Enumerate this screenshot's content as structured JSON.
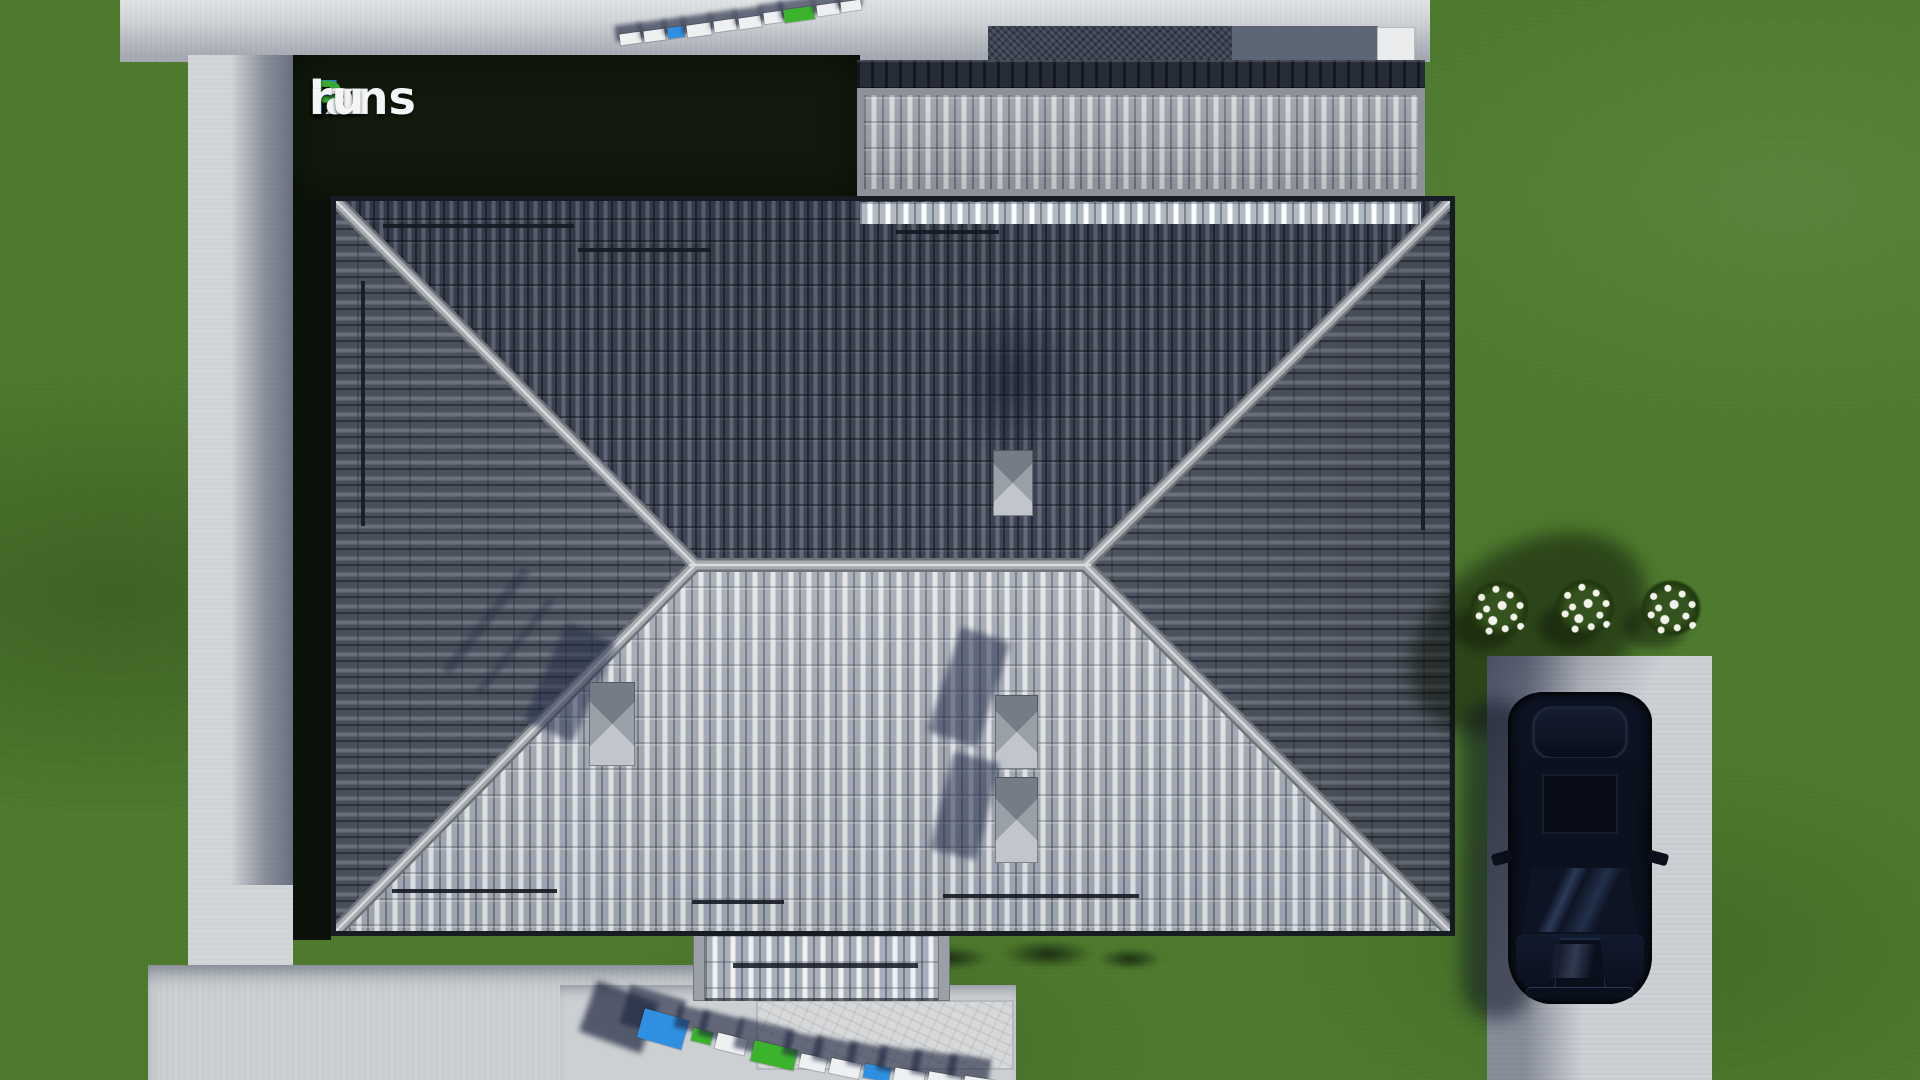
{
  "watermark": {
    "text": "FixPlans.ru",
    "background": "#111a0c",
    "segments": [
      {
        "t": "F",
        "c": "#2f7ee2"
      },
      {
        "t": "ix",
        "c": "#f4f5f6"
      },
      {
        "t": "P",
        "c": "#39a935"
      },
      {
        "t": "lans",
        "c": "#f4f5f6"
      },
      {
        "t": ".",
        "c": "#2f7ee2"
      },
      {
        "t": "ru",
        "c": "#f4f5f6"
      }
    ]
  },
  "ground_logos": {
    "colors": {
      "blue": "#2f8fe0",
      "green": "#3cb32d",
      "white": "#eef0f2"
    },
    "top": {
      "blocks": [
        {
          "x": 620,
          "y": 33,
          "w": 21,
          "h": 11,
          "rot": -8,
          "c": "white"
        },
        {
          "x": 644,
          "y": 30,
          "w": 21,
          "h": 11,
          "rot": -8,
          "c": "white"
        },
        {
          "x": 668,
          "y": 27,
          "w": 16,
          "h": 11,
          "rot": -8,
          "c": "blue"
        },
        {
          "x": 687,
          "y": 24,
          "w": 24,
          "h": 12,
          "rot": -8,
          "c": "white"
        },
        {
          "x": 714,
          "y": 20,
          "w": 22,
          "h": 11,
          "rot": -8,
          "c": "white"
        },
        {
          "x": 739,
          "y": 17,
          "w": 22,
          "h": 11,
          "rot": -8,
          "c": "white"
        },
        {
          "x": 764,
          "y": 12,
          "w": 18,
          "h": 11,
          "rot": -8,
          "c": "white"
        },
        {
          "x": 784,
          "y": 8,
          "w": 30,
          "h": 13,
          "rot": -8,
          "c": "green"
        },
        {
          "x": 817,
          "y": 4,
          "w": 22,
          "h": 11,
          "rot": -8,
          "c": "white"
        },
        {
          "x": 841,
          "y": 1,
          "w": 20,
          "h": 10,
          "rot": -8,
          "c": "white"
        }
      ]
    },
    "bottom": {
      "blocks": [
        {
          "x": 640,
          "y": 1014,
          "w": 46,
          "h": 30,
          "rot": 16,
          "c": "blue"
        },
        {
          "x": 692,
          "y": 1030,
          "w": 20,
          "h": 13,
          "rot": 14,
          "c": "green"
        },
        {
          "x": 716,
          "y": 1036,
          "w": 30,
          "h": 16,
          "rot": 14,
          "c": "white"
        },
        {
          "x": 752,
          "y": 1045,
          "w": 44,
          "h": 21,
          "rot": 13,
          "c": "green"
        },
        {
          "x": 800,
          "y": 1056,
          "w": 26,
          "h": 14,
          "rot": 12,
          "c": "white"
        },
        {
          "x": 830,
          "y": 1061,
          "w": 30,
          "h": 15,
          "rot": 12,
          "c": "white"
        },
        {
          "x": 864,
          "y": 1066,
          "w": 26,
          "h": 14,
          "rot": 11,
          "c": "blue"
        },
        {
          "x": 894,
          "y": 1070,
          "w": 30,
          "h": 15,
          "rot": 10,
          "c": "white"
        },
        {
          "x": 928,
          "y": 1074,
          "w": 32,
          "h": 15,
          "rot": 10,
          "c": "white"
        },
        {
          "x": 964,
          "y": 1078,
          "w": 30,
          "h": 14,
          "rot": 9,
          "c": "white"
        }
      ]
    }
  },
  "counts": {
    "flower_bushes": 3,
    "roof_vents": 4,
    "cars": 1
  },
  "palette": {
    "grass": "#4e7a2d",
    "path": "#d3d6d9",
    "panelGreen": "#111a0c",
    "concrete": "#ccd0d3",
    "stamped": "#d6d8da",
    "gravel": "#394150",
    "gravel2": "#5d6675",
    "frame": "#8d9298",
    "annexTop": "#262c38",
    "roofDarkA": "#3f4654",
    "roofDarkB": "#6a7183",
    "roofDarkGap": "#232834",
    "roofLightA": "#aab0ba",
    "roofLightB": "#eef0f3",
    "roofLightGap": "#767d8a",
    "roofSideA": "#575e6b",
    "roofSideB": "#7b8290",
    "roofSideGap": "#333945",
    "chimney": "#9aa0a8",
    "chimneyDark": "#767c86",
    "chimneyLight": "#c2c6cc",
    "flower": "#f2f4ec",
    "driveway": "#cdd1d6",
    "logoBlue": "#2f7ee2",
    "logoGreen": "#39a935"
  }
}
